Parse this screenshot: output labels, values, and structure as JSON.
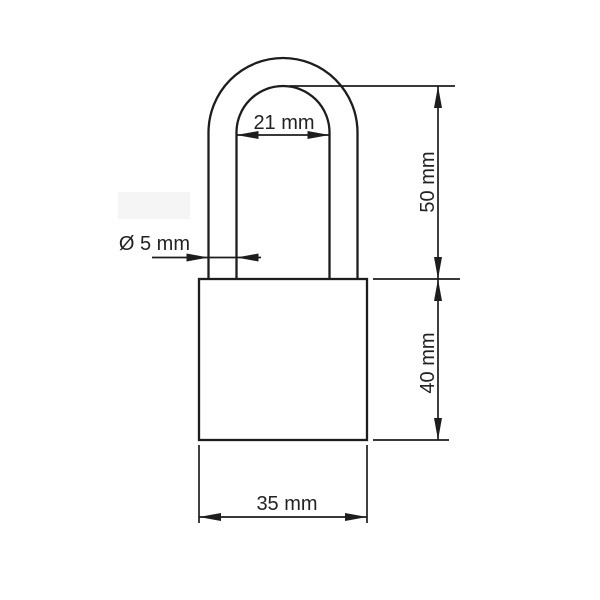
{
  "figure": {
    "type": "technical-dimension-drawing",
    "subject": "padlock"
  },
  "labels": {
    "shackle_inner_width": "21 mm",
    "shackle_wire_diameter": "Ø 5 mm",
    "shackle_height": "50 mm",
    "body_height": "40 mm",
    "body_width": "35 mm"
  },
  "colors": {
    "line": "#1d1d1d",
    "text": "#222222",
    "background": "#ffffff",
    "highlight_artifact": "#f5f5f5"
  }
}
